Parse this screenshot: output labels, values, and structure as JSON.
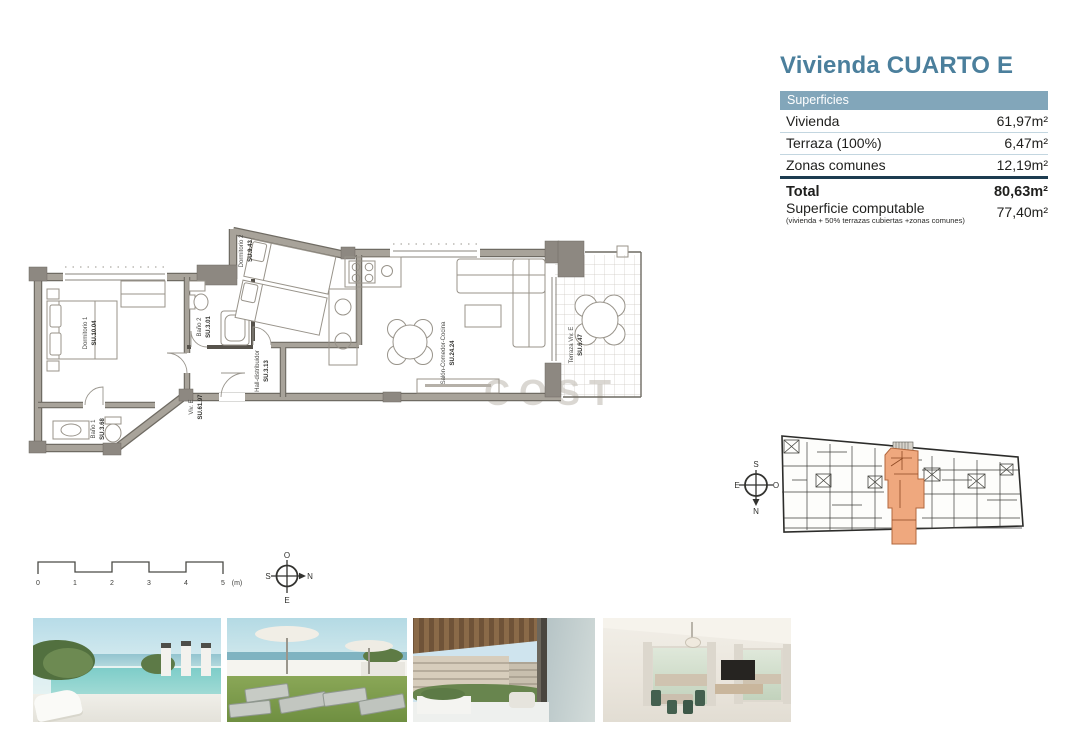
{
  "header": {
    "title": "Vivienda CUARTO E",
    "accent_color": "#4b7f9c"
  },
  "surfaces_table": {
    "header": "Superficies",
    "header_bg": "#82a6ba",
    "divider_color": "#1d3c50",
    "rows": [
      {
        "label": "Vivienda",
        "value": "61,97m²"
      },
      {
        "label": "Terraza (100%)",
        "value": "6,47m²"
      },
      {
        "label": "Zonas comunes",
        "value": "12,19m²"
      }
    ],
    "total_row": {
      "label": "Total",
      "value": "80,63m²"
    },
    "computable_row": {
      "label": "Superficie computable",
      "sublabel": "(vivienda + 50% terrazas cubiertas +zonas comunes)",
      "value": "77,40m²"
    }
  },
  "floor_plan": {
    "wall_color": "#a8a39a",
    "rooms": [
      {
        "name": "Dormitorio 1",
        "su": "SU.10.04"
      },
      {
        "name": "Baño 1",
        "su": "SU.3.68"
      },
      {
        "name": "Baño 2",
        "su": "SU.3.01"
      },
      {
        "name": "Dormitorio 2",
        "su": "SU.9.43"
      },
      {
        "name": "Hall-distribuidor",
        "su": "SU.3.13"
      },
      {
        "name": "Viv. E",
        "su": "SU.61.97"
      },
      {
        "name": "Salón-Comedor-Cocina",
        "su": "SU.24.24"
      },
      {
        "name": "Terraza Viv. E",
        "su": "SU.6.47"
      }
    ],
    "scale_bar": {
      "ticks": [
        "0",
        "1",
        "2",
        "3",
        "4",
        "5"
      ],
      "unit": "(m)"
    },
    "compass": {
      "top": "O",
      "left": "S",
      "right": "N",
      "bottom": "E"
    }
  },
  "key_plan": {
    "highlight_color": "#efa87e",
    "compass": {
      "top": "S",
      "left": "E",
      "right": "O",
      "bottom": "N"
    }
  },
  "watermark": {
    "text": "COST"
  },
  "photos": [
    {
      "label": "rooftop-pool-render"
    },
    {
      "label": "solarium-loungers-render"
    },
    {
      "label": "terrace-view-render"
    },
    {
      "label": "living-room-render"
    }
  ]
}
